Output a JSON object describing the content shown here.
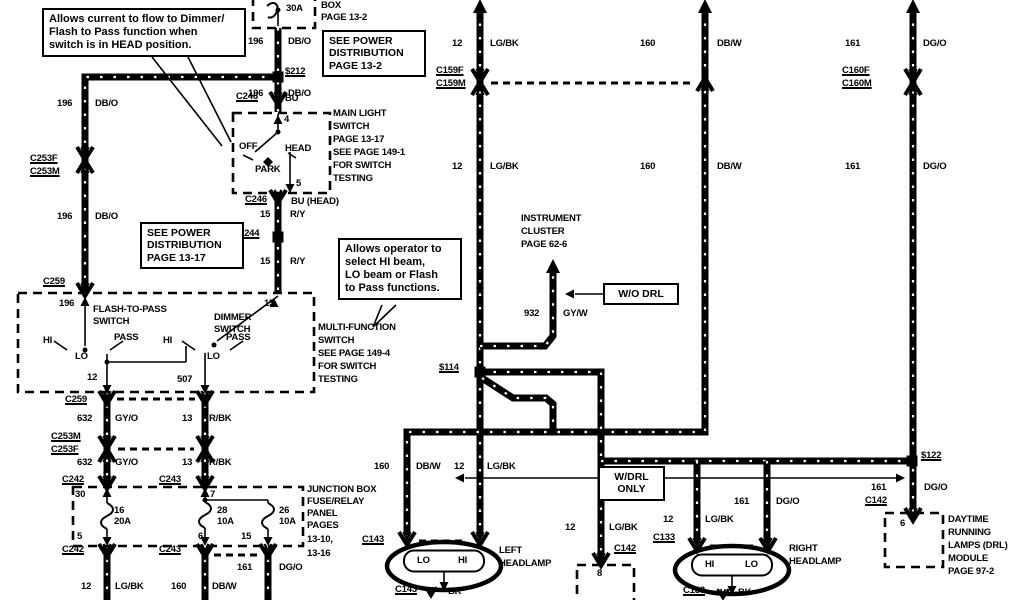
{
  "diagram": {
    "kind": "automotive wiring diagram - headlamp / DRL circuit",
    "colors": {
      "foreground": "#000000",
      "background": "#ffffff"
    },
    "notes": [
      {
        "id": "note-current-flow",
        "x": 42,
        "y": 8,
        "w": 190,
        "fs": 11,
        "lines": [
          "Allows current to flow to Dimmer/",
          "Flash  to  Pass  function  when",
          "switch is in HEAD position."
        ]
      },
      {
        "id": "note-see-power-distribution-1",
        "x": 322,
        "y": 30,
        "w": 90,
        "fs": 10.5,
        "lines": [
          "SEE  POWER",
          "DISTRIBUTION",
          "PAGE 13-2"
        ]
      },
      {
        "id": "note-see-power-distribution-2",
        "x": 140,
        "y": 222,
        "w": 90,
        "fs": 10.5,
        "lines": [
          "SEE  POWER",
          "DISTRIBUTION",
          "PAGE 13-17"
        ]
      },
      {
        "id": "note-operator",
        "x": 338,
        "y": 238,
        "w": 110,
        "fs": 11,
        "lines": [
          "Allows operator to",
          "select  HI  beam,",
          "LO beam or Flash",
          "to Pass functions."
        ]
      },
      {
        "id": "note-wo-drl",
        "x": 603,
        "y": 283,
        "w": 62,
        "fs": 10.5,
        "center": 1,
        "lines": [
          "W/O  DRL"
        ]
      },
      {
        "id": "note-wdrl-only",
        "x": 598,
        "y": 466,
        "w": 53,
        "fs": 10.5,
        "center": 1,
        "lines": [
          "W/DRL",
          "ONLY"
        ]
      }
    ],
    "labels": [
      {
        "t": "30A",
        "x": 286,
        "y": 4
      },
      {
        "t": "BOX",
        "x": 321,
        "y": 1
      },
      {
        "t": "PAGE 13-2",
        "x": 321,
        "y": 13
      },
      {
        "t": "196",
        "x": 248,
        "y": 37
      },
      {
        "t": "DB/O",
        "x": 288,
        "y": 37
      },
      {
        "t": "$212",
        "x": 285,
        "y": 67,
        "u": 1,
        "n": "splice-s212-label"
      },
      {
        "t": "196",
        "x": 248,
        "y": 89
      },
      {
        "t": "DB/O",
        "x": 288,
        "y": 89
      },
      {
        "t": "C246",
        "x": 236,
        "y": 92,
        "u": 1
      },
      {
        "t": "BU",
        "x": 285,
        "y": 94
      },
      {
        "t": "12",
        "x": 452,
        "y": 39
      },
      {
        "t": "LG/BK",
        "x": 490,
        "y": 39
      },
      {
        "t": "160",
        "x": 640,
        "y": 39
      },
      {
        "t": "DB/W",
        "x": 717,
        "y": 39
      },
      {
        "t": "161",
        "x": 845,
        "y": 39
      },
      {
        "t": "DG/O",
        "x": 923,
        "y": 39
      },
      {
        "t": "C159F",
        "x": 436,
        "y": 66,
        "u": 1
      },
      {
        "t": "C159M",
        "x": 436,
        "y": 79,
        "u": 1
      },
      {
        "t": "C160F",
        "x": 842,
        "y": 66,
        "u": 1
      },
      {
        "t": "C160M",
        "x": 842,
        "y": 79,
        "u": 1
      },
      {
        "t": "12",
        "x": 452,
        "y": 162
      },
      {
        "t": "LG/BK",
        "x": 490,
        "y": 162
      },
      {
        "t": "160",
        "x": 640,
        "y": 162
      },
      {
        "t": "DB/W",
        "x": 717,
        "y": 162
      },
      {
        "t": "161",
        "x": 845,
        "y": 162
      },
      {
        "t": "DG/O",
        "x": 923,
        "y": 162
      },
      {
        "t": "196",
        "x": 57,
        "y": 99
      },
      {
        "t": "DB/O",
        "x": 95,
        "y": 99
      },
      {
        "t": "C253F",
        "x": 30,
        "y": 154,
        "u": 1
      },
      {
        "t": "C253M",
        "x": 30,
        "y": 167,
        "u": 1
      },
      {
        "t": "196",
        "x": 57,
        "y": 212
      },
      {
        "t": "DB/O",
        "x": 95,
        "y": 212
      },
      {
        "t": "MAIN LIGHT",
        "x": 333,
        "y": 109
      },
      {
        "t": "SWITCH",
        "x": 333,
        "y": 122
      },
      {
        "t": "PAGE 13-17",
        "x": 333,
        "y": 135
      },
      {
        "t": "SEE PAGE 149-1",
        "x": 333,
        "y": 148
      },
      {
        "t": "FOR SWITCH",
        "x": 333,
        "y": 161
      },
      {
        "t": "TESTING",
        "x": 333,
        "y": 174
      },
      {
        "t": "4",
        "x": 284,
        "y": 115
      },
      {
        "t": "5",
        "x": 296,
        "y": 179
      },
      {
        "t": "OFF",
        "x": 239,
        "y": 142
      },
      {
        "t": "HEAD",
        "x": 285,
        "y": 144
      },
      {
        "t": "PARK",
        "x": 255,
        "y": 165
      },
      {
        "t": "C246",
        "x": 245,
        "y": 195,
        "u": 1
      },
      {
        "t": "BU (HEAD)",
        "x": 291,
        "y": 197
      },
      {
        "t": "15",
        "x": 260,
        "y": 210
      },
      {
        "t": "R/Y",
        "x": 290,
        "y": 210
      },
      {
        "t": "$244",
        "x": 239,
        "y": 229,
        "u": 1,
        "n": "splice-s244-label"
      },
      {
        "t": "15",
        "x": 260,
        "y": 257
      },
      {
        "t": "R/Y",
        "x": 290,
        "y": 257
      },
      {
        "t": "C259",
        "x": 43,
        "y": 277,
        "u": 1
      },
      {
        "t": "196",
        "x": 59,
        "y": 299
      },
      {
        "t": "15",
        "x": 264,
        "y": 299
      },
      {
        "t": "FLASH-TO-PASS",
        "x": 93,
        "y": 305
      },
      {
        "t": "SWITCH",
        "x": 93,
        "y": 317
      },
      {
        "t": "DIMMER",
        "x": 214,
        "y": 313
      },
      {
        "t": "SWITCH",
        "x": 214,
        "y": 325
      },
      {
        "t": "HI",
        "x": 43,
        "y": 336
      },
      {
        "t": "PASS",
        "x": 114,
        "y": 333
      },
      {
        "t": "LO",
        "x": 75,
        "y": 352
      },
      {
        "t": "HI",
        "x": 163,
        "y": 336
      },
      {
        "t": "PASS",
        "x": 226,
        "y": 333
      },
      {
        "t": "LO",
        "x": 207,
        "y": 352
      },
      {
        "t": "MULTI-FUNCTION",
        "x": 318,
        "y": 323
      },
      {
        "t": "SWITCH",
        "x": 318,
        "y": 336
      },
      {
        "t": "SEE PAGE 149-4",
        "x": 318,
        "y": 349
      },
      {
        "t": "FOR SWITCH",
        "x": 318,
        "y": 362
      },
      {
        "t": "TESTING",
        "x": 318,
        "y": 375
      },
      {
        "t": "12",
        "x": 87,
        "y": 373
      },
      {
        "t": "507",
        "x": 177,
        "y": 375
      },
      {
        "t": "C259",
        "x": 65,
        "y": 395,
        "u": 1
      },
      {
        "t": "632",
        "x": 77,
        "y": 414
      },
      {
        "t": "GY/O",
        "x": 115,
        "y": 414
      },
      {
        "t": "13",
        "x": 182,
        "y": 414
      },
      {
        "t": "R/BK",
        "x": 209,
        "y": 414
      },
      {
        "t": "C253M",
        "x": 51,
        "y": 432,
        "u": 1
      },
      {
        "t": "C253F",
        "x": 51,
        "y": 445,
        "u": 1
      },
      {
        "t": "632",
        "x": 77,
        "y": 458
      },
      {
        "t": "GY/O",
        "x": 115,
        "y": 458
      },
      {
        "t": "13",
        "x": 182,
        "y": 458
      },
      {
        "t": "R/BK",
        "x": 209,
        "y": 458
      },
      {
        "t": "C242",
        "x": 62,
        "y": 475,
        "u": 1
      },
      {
        "t": "C243",
        "x": 159,
        "y": 475,
        "u": 1
      },
      {
        "t": "30",
        "x": 75,
        "y": 490
      },
      {
        "t": "7",
        "x": 210,
        "y": 490
      },
      {
        "t": "16",
        "x": 114,
        "y": 506
      },
      {
        "t": "20A",
        "x": 114,
        "y": 517
      },
      {
        "t": "28",
        "x": 217,
        "y": 506
      },
      {
        "t": "10A",
        "x": 217,
        "y": 517
      },
      {
        "t": "26",
        "x": 279,
        "y": 506
      },
      {
        "t": "10A",
        "x": 279,
        "y": 517
      },
      {
        "t": "5",
        "x": 77,
        "y": 532
      },
      {
        "t": "6",
        "x": 198,
        "y": 532
      },
      {
        "t": "15",
        "x": 241,
        "y": 532
      },
      {
        "t": "JUNCTION BOX",
        "x": 307,
        "y": 485
      },
      {
        "t": "FUSE/RELAY",
        "x": 307,
        "y": 497
      },
      {
        "t": "PANEL",
        "x": 307,
        "y": 509
      },
      {
        "t": "PAGES",
        "x": 307,
        "y": 521
      },
      {
        "t": "13-10,",
        "x": 307,
        "y": 535
      },
      {
        "t": "13-16",
        "x": 307,
        "y": 549
      },
      {
        "t": "C242",
        "x": 62,
        "y": 545,
        "u": 1
      },
      {
        "t": "C243",
        "x": 159,
        "y": 545,
        "u": 1
      },
      {
        "t": "161",
        "x": 237,
        "y": 563
      },
      {
        "t": "DG/O",
        "x": 279,
        "y": 563
      },
      {
        "t": "12",
        "x": 81,
        "y": 582
      },
      {
        "t": "LG/BK",
        "x": 115,
        "y": 582
      },
      {
        "t": "160",
        "x": 171,
        "y": 582
      },
      {
        "t": "DB/W",
        "x": 212,
        "y": 582
      },
      {
        "t": "INSTRUMENT",
        "x": 521,
        "y": 214
      },
      {
        "t": "CLUSTER",
        "x": 521,
        "y": 227
      },
      {
        "t": "PAGE 62-6",
        "x": 521,
        "y": 240
      },
      {
        "t": "932",
        "x": 524,
        "y": 309
      },
      {
        "t": "GY/W",
        "x": 563,
        "y": 309
      },
      {
        "t": "$114",
        "x": 439,
        "y": 363,
        "u": 1,
        "n": "splice-s114-label"
      },
      {
        "t": "160",
        "x": 374,
        "y": 462
      },
      {
        "t": "DB/W",
        "x": 416,
        "y": 462
      },
      {
        "t": "12",
        "x": 454,
        "y": 462
      },
      {
        "t": "LG/BK",
        "x": 487,
        "y": 462
      },
      {
        "t": "C143",
        "x": 362,
        "y": 535,
        "u": 1
      },
      {
        "t": "LEFT",
        "x": 499,
        "y": 546
      },
      {
        "t": "HEADLAMP",
        "x": 499,
        "y": 559
      },
      {
        "t": "LO",
        "x": 417,
        "y": 556
      },
      {
        "t": "HI",
        "x": 458,
        "y": 556
      },
      {
        "t": "C143",
        "x": 395,
        "y": 585,
        "u": 1
      },
      {
        "t": "BK",
        "x": 448,
        "y": 587
      },
      {
        "t": "12",
        "x": 565,
        "y": 523
      },
      {
        "t": "LG/BK",
        "x": 609,
        "y": 523
      },
      {
        "t": "C142",
        "x": 614,
        "y": 544,
        "u": 1
      },
      {
        "t": "8",
        "x": 597,
        "y": 569
      },
      {
        "t": "12",
        "x": 663,
        "y": 515
      },
      {
        "t": "LG/BK",
        "x": 705,
        "y": 515
      },
      {
        "t": "C133",
        "x": 653,
        "y": 533,
        "u": 1
      },
      {
        "t": "161",
        "x": 734,
        "y": 497
      },
      {
        "t": "DG/O",
        "x": 776,
        "y": 497
      },
      {
        "t": "RIGHT",
        "x": 789,
        "y": 544
      },
      {
        "t": "HEADLAMP",
        "x": 789,
        "y": 557
      },
      {
        "t": "HI",
        "x": 705,
        "y": 560
      },
      {
        "t": "LO",
        "x": 745,
        "y": 560
      },
      {
        "t": "C133",
        "x": 683,
        "y": 586,
        "u": 1
      },
      {
        "t": "BK",
        "x": 738,
        "y": 588
      },
      {
        "t": "$122",
        "x": 921,
        "y": 451,
        "u": 1,
        "n": "splice-s122-label"
      },
      {
        "t": "161",
        "x": 871,
        "y": 483
      },
      {
        "t": "DG/O",
        "x": 924,
        "y": 483
      },
      {
        "t": "C142",
        "x": 865,
        "y": 496,
        "u": 1
      },
      {
        "t": "6",
        "x": 900,
        "y": 519
      },
      {
        "t": "DAYTIME",
        "x": 948,
        "y": 515
      },
      {
        "t": "RUNNING",
        "x": 948,
        "y": 528
      },
      {
        "t": "LAMPS (DRL)",
        "x": 948,
        "y": 541
      },
      {
        "t": "MODULE",
        "x": 948,
        "y": 554
      },
      {
        "t": "PAGE 97-2",
        "x": 948,
        "y": 567
      }
    ]
  }
}
